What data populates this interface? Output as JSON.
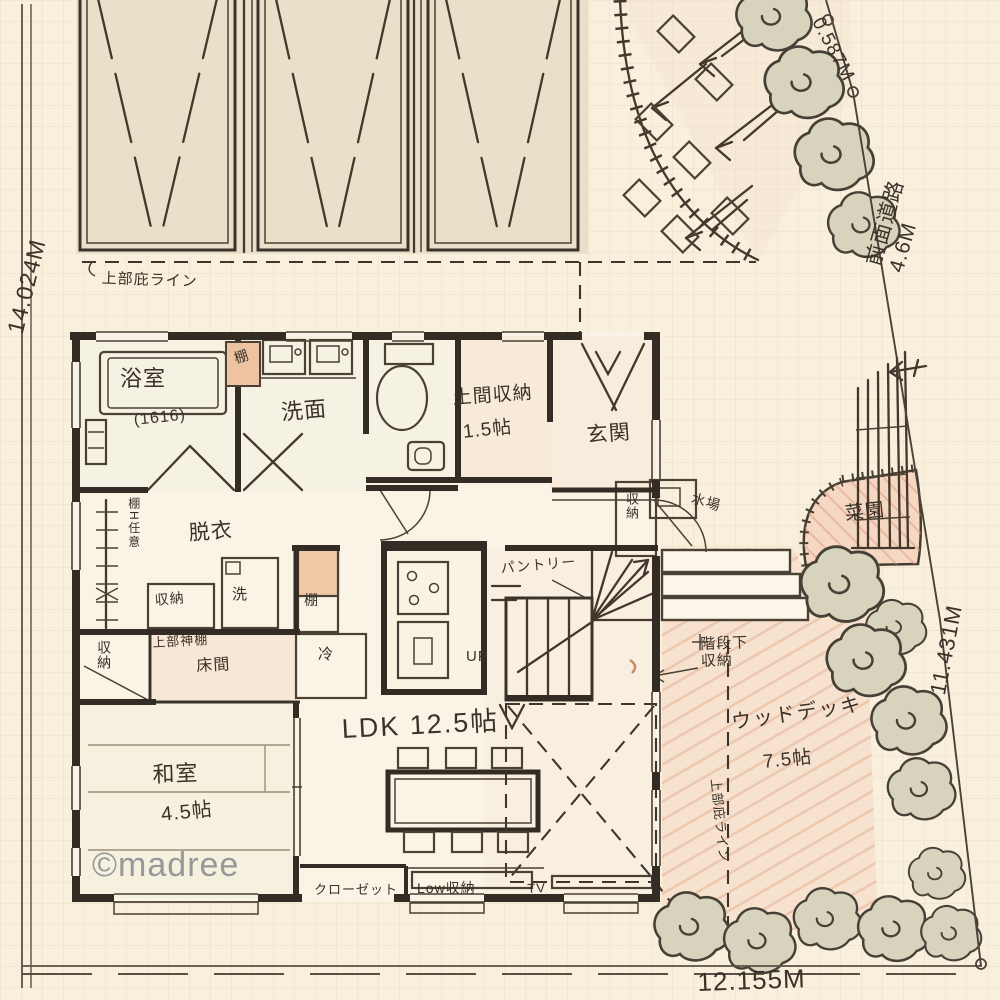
{
  "meta": {
    "watermark": "©madree"
  },
  "dimensions": {
    "west": "14.024M",
    "south": "12.155M",
    "east": "11.431M",
    "corner_cut": "0.587M",
    "front_road": "前面道路 4.6M"
  },
  "site": {
    "eave_line_top": "上部庇ライン",
    "eave_line_deck": "上部庇ライン",
    "garden_bed": "菜園",
    "water_place": "水場",
    "wood_deck": "ウッドデッキ",
    "wood_deck_size": "7.5帖"
  },
  "house": {
    "bath": "浴室",
    "bath_size": "(1616)",
    "shelf_a": "棚",
    "washroom": "洗面",
    "doma_storage": "土間収納",
    "doma_storage_size": "1.5帖",
    "entrance": "玄関",
    "entrance_storage": "収納",
    "dressing": "脱衣",
    "shelf_note": "棚H任意",
    "laundry_storage": "収納",
    "washer": "洗",
    "shelf_b": "棚",
    "fridge": "冷",
    "kamidana": "上部神棚",
    "tokonoma": "床間",
    "closet_storage": "収納",
    "washitsu": "和室",
    "washitsu_size": "4.5帖",
    "ldk": "LDK 12.5帖",
    "pantry": "パントリー",
    "stairs_up": "UP",
    "under_stairs": "階段下\n収納",
    "closet": "クローゼット",
    "low_storage": "Low収納",
    "tv": "TV"
  }
}
